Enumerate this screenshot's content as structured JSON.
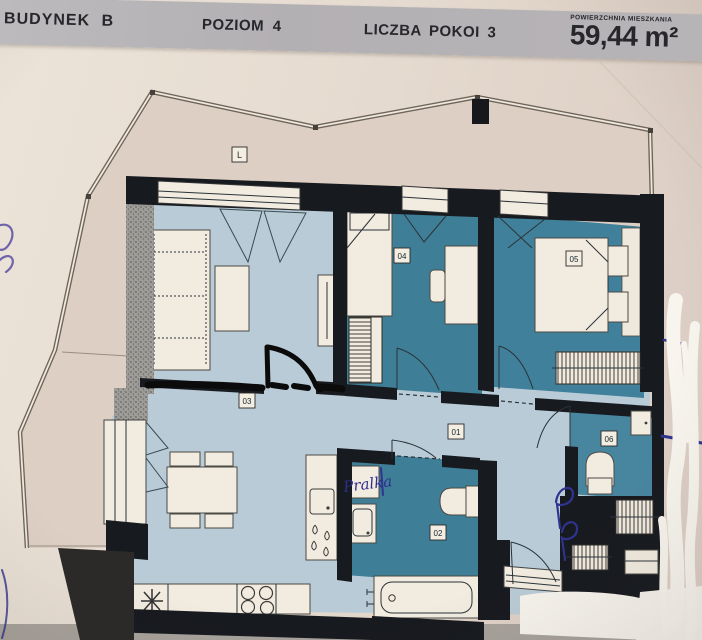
{
  "header": {
    "building": "BUDYNEK B",
    "level": "POZIOM 4",
    "rooms_count": "LICZBA POKOI 3",
    "area_caption": "POWIERZCHNIA MIESZKANIA",
    "area_value": "59,44 m²"
  },
  "plan": {
    "balcony_label": "L",
    "handwritten_note": "Pralka",
    "room_labels": {
      "r01": "01",
      "r02": "02",
      "r03": "03",
      "r04": "04",
      "r05": "05",
      "r06": "06"
    },
    "colors": {
      "header_bg": "#b6b3b6",
      "paper": "#e7ddd2",
      "balcony_floor": "#ddcfc4",
      "floor_light_blue": "#b9cbd6",
      "floor_teal": "#3f7e97",
      "wall_black": "#171a1f",
      "furniture_white": "#f1ebe0",
      "ink_blue": "#30338f",
      "whiteout": "#f8f5ee"
    }
  }
}
